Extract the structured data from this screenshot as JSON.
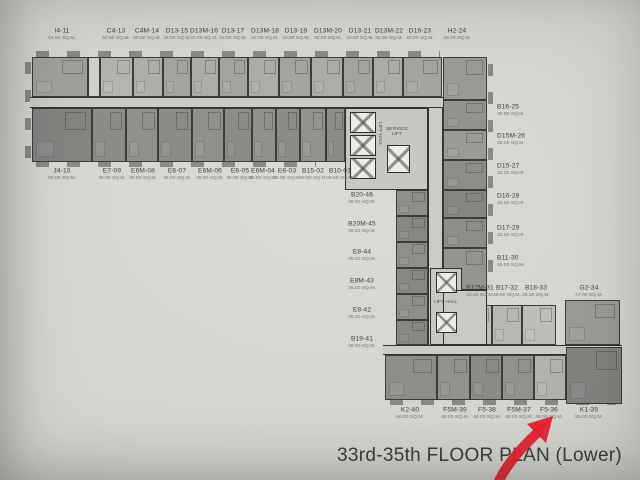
{
  "meta": {
    "title": "33rd-35th FLOOR PLAN (Lower)"
  },
  "annotation": {
    "type": "hand-drawn-arrow",
    "color": "#e62330",
    "points_to": "F5-36"
  },
  "core": {
    "lift_hall": "LIFT HALL",
    "service_lift": "SERVICE\nLIFT",
    "lift_hall2": "LIFT HALL"
  },
  "units": {
    "groups": [
      {
        "name": "top-row",
        "y": 57,
        "h": 40,
        "ly": 28,
        "align": "center",
        "cells": [
          {
            "code": "I4-11",
            "area": "54.50 SQ.M.",
            "x": 32,
            "w": 56,
            "lx": 62,
            "fill": "#a0a09d"
          },
          {
            "code": "C4-13",
            "area": "50.50 SQ.M.",
            "x": 100,
            "w": 33,
            "lx": 116,
            "fill": "#b4b4b1"
          },
          {
            "code": "C4M-14",
            "area": "50.50 SQ.M.",
            "x": 133,
            "w": 30,
            "lx": 147,
            "fill": "#aeaeab"
          },
          {
            "code": "D13-15",
            "area": "32.00 SQ.M.",
            "x": 163,
            "w": 28,
            "lx": 177,
            "fill": "#a4a4a1"
          },
          {
            "code": "D13M-16",
            "area": "32.00 SQ.M.",
            "x": 191,
            "w": 28,
            "lx": 204,
            "fill": "#acaca9"
          },
          {
            "code": "D13-17",
            "area": "32.00 SQ.M.",
            "x": 219,
            "w": 29,
            "lx": 233,
            "fill": "#a4a4a1"
          },
          {
            "code": "D13M-18",
            "area": "32.00 SQ.M.",
            "x": 248,
            "w": 31,
            "lx": 265,
            "fill": "#acaca9"
          },
          {
            "code": "D13-19",
            "area": "32.00 SQ.M.",
            "x": 279,
            "w": 32,
            "lx": 296,
            "fill": "#a4a4a1"
          },
          {
            "code": "D13M-20",
            "area": "32.00 SQ.M.",
            "x": 311,
            "w": 32,
            "lx": 328,
            "fill": "#acaca9"
          },
          {
            "code": "D13-21",
            "area": "32.00 SQ.M.",
            "x": 343,
            "w": 30,
            "lx": 360,
            "fill": "#a4a4a1"
          },
          {
            "code": "D13M-22",
            "area": "32.00 SQ.M.",
            "x": 373,
            "w": 30,
            "lx": 389,
            "fill": "#acaca9"
          },
          {
            "code": "D16-23",
            "area": "40.00 SQ.M.",
            "x": 403,
            "w": 39,
            "lx": 420,
            "fill": "#a4a4a1"
          },
          {
            "code": "H2-24",
            "area": "40.00 SQ.M.",
            "x": 443,
            "w": 44,
            "y": 57,
            "h": 43,
            "lx": 457,
            "fill": "#9a9a97"
          }
        ]
      },
      {
        "name": "mid-row",
        "y": 108,
        "h": 54,
        "ly": 168,
        "align": "center",
        "cells": [
          {
            "code": "J4-10",
            "area": "55.00 SQ.M.",
            "x": 32,
            "w": 60,
            "lx": 62,
            "fill": "#838380"
          },
          {
            "code": "E7-09",
            "area": "35.00 SQ.M.",
            "x": 92,
            "w": 34,
            "lx": 112,
            "fill": "#8b8b88"
          },
          {
            "code": "E6M-08",
            "area": "35.50 SQ.M.",
            "x": 126,
            "w": 32,
            "lx": 143,
            "fill": "#90908d"
          },
          {
            "code": "E6-07",
            "area": "35.00 SQ.M.",
            "x": 158,
            "w": 34,
            "lx": 177,
            "fill": "#8b8b88"
          },
          {
            "code": "E6M-06",
            "area": "35.50 SQ.M.",
            "x": 192,
            "w": 32,
            "lx": 210,
            "fill": "#90908d"
          },
          {
            "code": "E6-05",
            "area": "35.00 SQ.M.",
            "x": 224,
            "w": 28,
            "lx": 240,
            "fill": "#8b8b88"
          },
          {
            "code": "E6M-04",
            "area": "35.50 SQ.M.",
            "x": 252,
            "w": 24,
            "lx": 263,
            "fill": "#90908d"
          },
          {
            "code": "E6-03",
            "area": "35.00 SQ.M.",
            "x": 276,
            "w": 24,
            "lx": 287,
            "fill": "#8b8b88"
          },
          {
            "code": "B15-02",
            "area": "38.50 SQ.M.",
            "x": 300,
            "w": 26,
            "lx": 313,
            "fill": "#92928f"
          },
          {
            "code": "B10-01",
            "area": "38.50 SQ.M.",
            "x": 326,
            "w": 19,
            "lx": 340,
            "fill": "#8b8b88"
          }
        ]
      },
      {
        "name": "right-column",
        "x": 443,
        "w": 44,
        "align": "left",
        "lxd": 497,
        "cells": [
          {
            "code": "B16-25",
            "area": "38.50 SQ.M.",
            "x": 443,
            "w": 44,
            "y": 100,
            "h": 30,
            "lx": 497,
            "ly": 104,
            "fill": "#92928f"
          },
          {
            "code": "D15M-26",
            "area": "32.00 SQ.M.",
            "x": 443,
            "w": 44,
            "y": 130,
            "h": 30,
            "lx": 497,
            "ly": 133,
            "fill": "#9a9a97"
          },
          {
            "code": "D15-27",
            "area": "32.00 SQ.M.",
            "x": 443,
            "w": 44,
            "y": 160,
            "h": 30,
            "lx": 497,
            "ly": 163,
            "fill": "#8d8d8a"
          },
          {
            "code": "D16-28",
            "area": "32.50 SQ.M.",
            "x": 443,
            "w": 44,
            "y": 190,
            "h": 28,
            "lx": 497,
            "ly": 193,
            "fill": "#858582"
          },
          {
            "code": "D17-29",
            "area": "32.50 SQ.M.",
            "x": 443,
            "w": 44,
            "y": 218,
            "h": 30,
            "lx": 497,
            "ly": 225,
            "fill": "#8d8d8a"
          },
          {
            "code": "B11-30",
            "area": "45.50 SQ.M.",
            "x": 443,
            "w": 44,
            "y": 248,
            "h": 42,
            "lx": 497,
            "ly": 255,
            "fill": "#949491"
          }
        ]
      },
      {
        "name": "left-column",
        "align": "center",
        "cells": [
          {
            "code": "B20-46",
            "area": "38.50 SQ.M.",
            "x": 396,
            "w": 32,
            "y": 190,
            "h": 26,
            "lx": 362,
            "ly": 192,
            "fill": "#8e8e8b"
          },
          {
            "code": "B20M-45",
            "area": "38.50 SQ.M.",
            "x": 396,
            "w": 32,
            "y": 216,
            "h": 26,
            "lx": 362,
            "ly": 221,
            "fill": "#878784"
          },
          {
            "code": "E8-44",
            "area": "35.00 SQ.M.",
            "x": 396,
            "w": 32,
            "y": 242,
            "h": 26,
            "lx": 362,
            "ly": 249,
            "fill": "#8e8e8b"
          },
          {
            "code": "E8M-43",
            "area": "35.00 SQ.M.",
            "x": 396,
            "w": 32,
            "y": 268,
            "h": 26,
            "lx": 362,
            "ly": 278,
            "fill": "#878784"
          },
          {
            "code": "E8-42",
            "area": "35.00 SQ.M.",
            "x": 396,
            "w": 32,
            "y": 294,
            "h": 26,
            "lx": 362,
            "ly": 307,
            "fill": "#8e8e8b"
          },
          {
            "code": "B19-41",
            "area": "38.50 SQ.M.",
            "x": 396,
            "w": 32,
            "y": 320,
            "h": 25,
            "lx": 362,
            "ly": 336,
            "fill": "#878784"
          }
        ]
      },
      {
        "name": "bottom-upper-row",
        "y": 305,
        "h": 40,
        "ly": 285,
        "align": "center",
        "cells": [
          {
            "code": "B17M-31",
            "area": "33.50 SQ.M.",
            "x": 462,
            "w": 30,
            "lx": 480,
            "fill": "#bdbdba"
          },
          {
            "code": "B17-32",
            "area": "28.50 SQ.M.",
            "x": 492,
            "w": 30,
            "lx": 507,
            "fill": "#b7b7b4"
          },
          {
            "code": "B18-33",
            "area": "28.50 SQ.M.",
            "x": 522,
            "w": 34,
            "lx": 536,
            "fill": "#bdbdba"
          },
          {
            "code": "G2-34",
            "area": "47.00 SQ.M.",
            "x": 565,
            "w": 55,
            "y": 300,
            "h": 45,
            "lx": 589,
            "fill": "#9a9a97"
          }
        ]
      },
      {
        "name": "bottom-row",
        "y": 355,
        "h": 45,
        "ly": 407,
        "align": "center",
        "cells": [
          {
            "code": "K2-40",
            "area": "56.00 SQ.M.",
            "x": 385,
            "w": 52,
            "lx": 410,
            "fill": "#8d8d8a"
          },
          {
            "code": "F5M-39",
            "area": "48.00 SQ.M.",
            "x": 437,
            "w": 33,
            "lx": 455,
            "fill": "#91918e"
          },
          {
            "code": "F5-38",
            "area": "48.00 SQ.M.",
            "x": 470,
            "w": 32,
            "lx": 487,
            "fill": "#8a8a87"
          },
          {
            "code": "F5M-37",
            "area": "48.00 SQ.M.",
            "x": 502,
            "w": 32,
            "lx": 519,
            "fill": "#91918e"
          },
          {
            "code": "F5-36",
            "area": "48.00 SQ.M.",
            "x": 534,
            "w": 32,
            "lx": 549,
            "fill": "#b1b1ae"
          },
          {
            "code": "K1-35",
            "area": "55.00 SQ.M.",
            "x": 566,
            "w": 56,
            "y": 347,
            "h": 57,
            "lx": 589,
            "fill": "#82827f"
          }
        ]
      }
    ]
  }
}
